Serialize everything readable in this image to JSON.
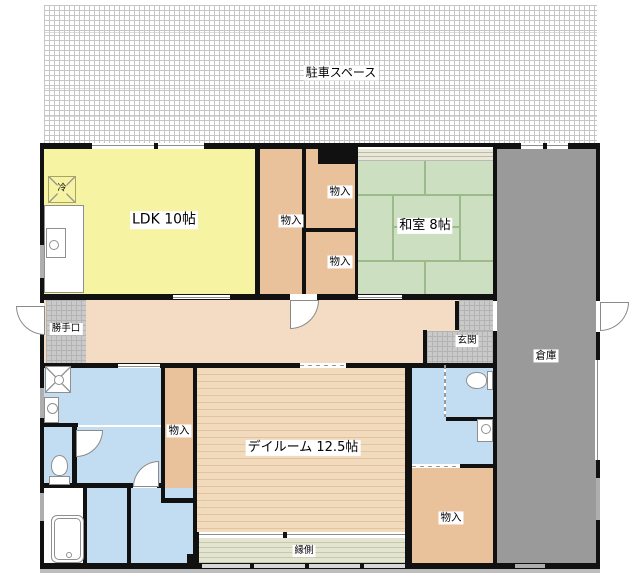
{
  "parking": {
    "label": "駐車スペース"
  },
  "labels": {
    "ldk": "LDK 10帖",
    "washitsu": "和室 8帖",
    "dayroom": "デイルーム 12.5帖",
    "storage": "倉庫",
    "veranda": "縁側",
    "genkan": "玄関",
    "katteguchi": "勝手口",
    "closet": "物入",
    "fridge": "冷"
  },
  "colors": {
    "wall": "#111111",
    "ldk": "#f6f3a3",
    "closet": "#e9c29c",
    "tatami": "#ccdfc0",
    "tatami_line": "#9cba8c",
    "corridor": "#f3dcc3",
    "dayroom": "#f1d8bb",
    "sanitary": "#c2ddf1",
    "storage": "#9a9a9a",
    "veranda": "#e3e4cf",
    "tile": "#c9c9c9"
  }
}
